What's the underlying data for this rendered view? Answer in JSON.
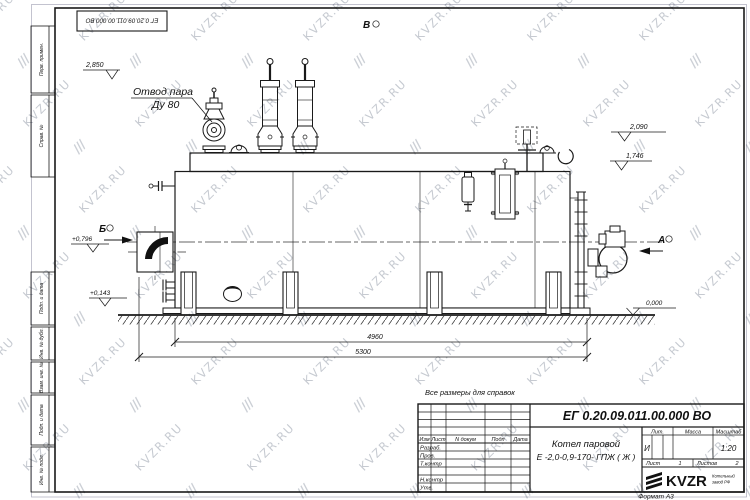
{
  "designation": "ЕГ 0.20.09.011.00.000  ВО",
  "watermark": {
    "text": "KVZR.RU",
    "glyph": "///"
  },
  "note": "Все размеры для справок",
  "format": "Формат А3",
  "drawing": {
    "callout_line1": "Отвод пара",
    "callout_line2": "Ду 80",
    "views": {
      "a": "А",
      "b": "Б",
      "v": "В"
    },
    "elevations": {
      "top": "2,850",
      "lug": "2,090",
      "drum": "1,746",
      "burner": "+0,796",
      "low": "+0,143",
      "ground": "0,000"
    },
    "dims": {
      "inner": "4960",
      "overall": "5300"
    }
  },
  "title_block": {
    "name_line1": "Котел паровой",
    "name_line2": "Е -2,0-0,9-170- ГПЖ ( Ж )",
    "cols": {
      "izm": "Изм",
      "list": "Лист",
      "ndoc": "N докум",
      "podp": "Подп",
      "data": "Дата"
    },
    "rows": {
      "razrab": "Разраб.",
      "prov": "Пров.",
      "tkontr": "Т.контр",
      "nkontr": "Н.контр",
      "utv": "Утв."
    },
    "lit_label": "Лит.",
    "massa_label": "Масса",
    "scale_label": "Масштаб",
    "lit_value": "И",
    "scale_value": "1:20",
    "sheet_label": "Лист",
    "sheet_value": "1",
    "sheets_label": "Листов",
    "sheets_value": "2",
    "logo_text": "KVZR",
    "logo_sub1": "Котельный",
    "logo_sub2": "завод РФ"
  },
  "margin": {
    "perv": "Перв. примен.",
    "sprav": "Справ. №",
    "podp1": "Подп. и дата",
    "inv_dubl": "Инв. № дубл.",
    "vzam": "Взам. инв. №",
    "podp2": "Подп. и дата",
    "inv_podl": "Инв. № подл."
  }
}
